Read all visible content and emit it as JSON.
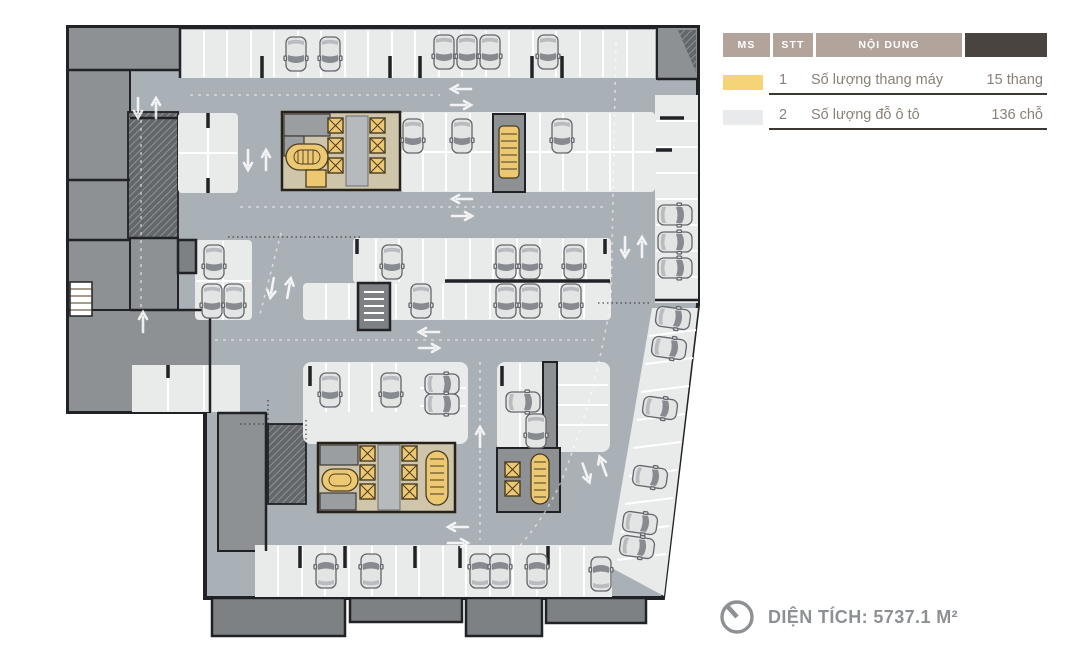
{
  "legend": {
    "header": {
      "col_ms": "MS",
      "col_stt": "STT",
      "col_content": "NỘI DUNG"
    },
    "rows": [
      {
        "stt": "1",
        "label": "Số lượng thang máy",
        "value": "15 thang",
        "swatch": "#f5d478"
      },
      {
        "stt": "2",
        "label": "Số lượng đỗ ô tô",
        "value": "136 chỗ",
        "swatch": "#e9eaeb"
      }
    ]
  },
  "footer": {
    "area_label": "DIỆN TÍCH: 5737.1 M²"
  },
  "icons": {
    "clock_icon": "clock-face-with-hand",
    "car_icon": "top-view-car",
    "elevator_icon": "square-with-x",
    "stair_icon": "stair-run",
    "arrow_icon": "traffic-direction-arrow"
  },
  "colors": {
    "road": "#a9b0b6",
    "stall": "#e9eaea",
    "room": "#8e9194",
    "room_dark": "#7d8184",
    "wall": "#212225",
    "core_bg": "#cfc5ab",
    "core_yellow": "#ecc873",
    "legend_header_bg": "#b2a49b",
    "legend_dark_cell": "#4a4441",
    "legend_text": "#8a8178",
    "underline": "#3b3733",
    "footer_gray": "#8e9194"
  }
}
